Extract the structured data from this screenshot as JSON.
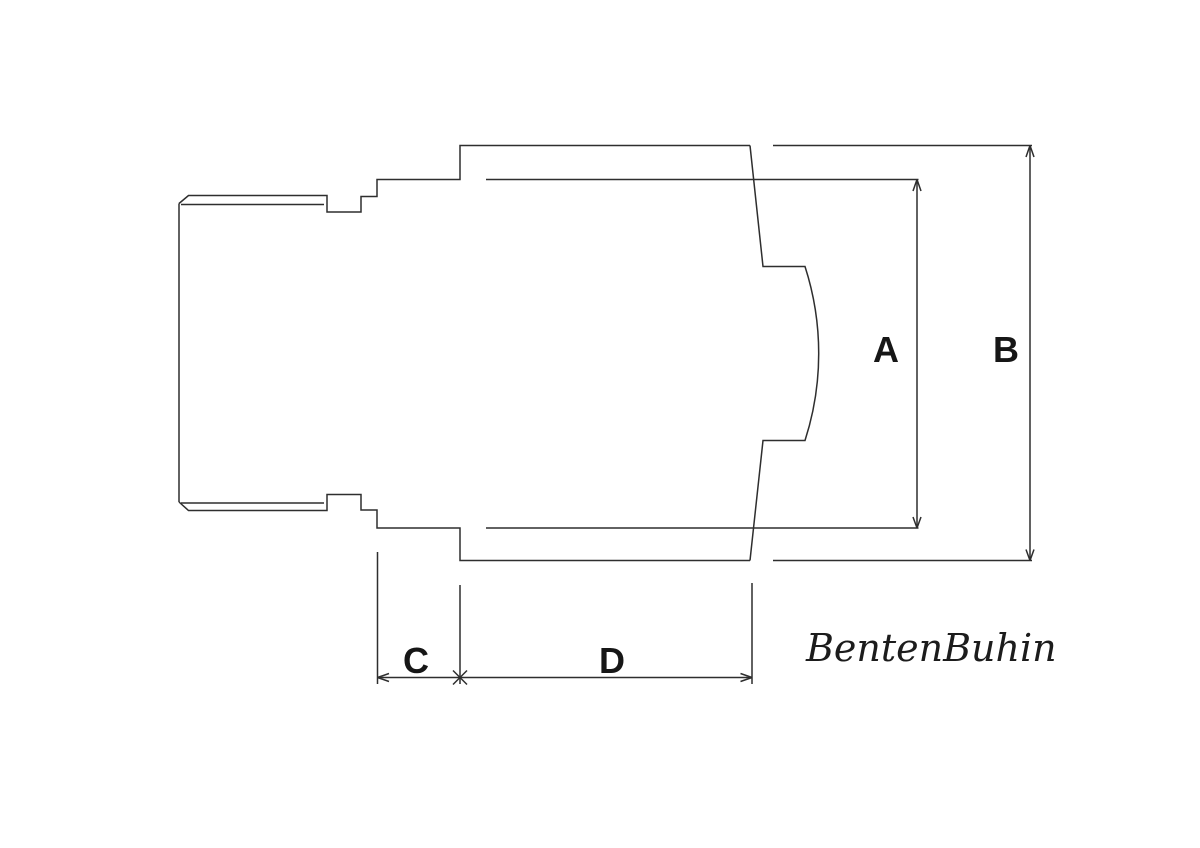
{
  "drawing": {
    "type": "technical-dimension-diagram",
    "dimension_labels": {
      "a": "A",
      "b": "B",
      "c": "C",
      "d": "D"
    },
    "signature": "BentenBuhin",
    "colors": {
      "line": "#2e2e2e",
      "label": "#161616",
      "background": "#ffffff"
    }
  }
}
